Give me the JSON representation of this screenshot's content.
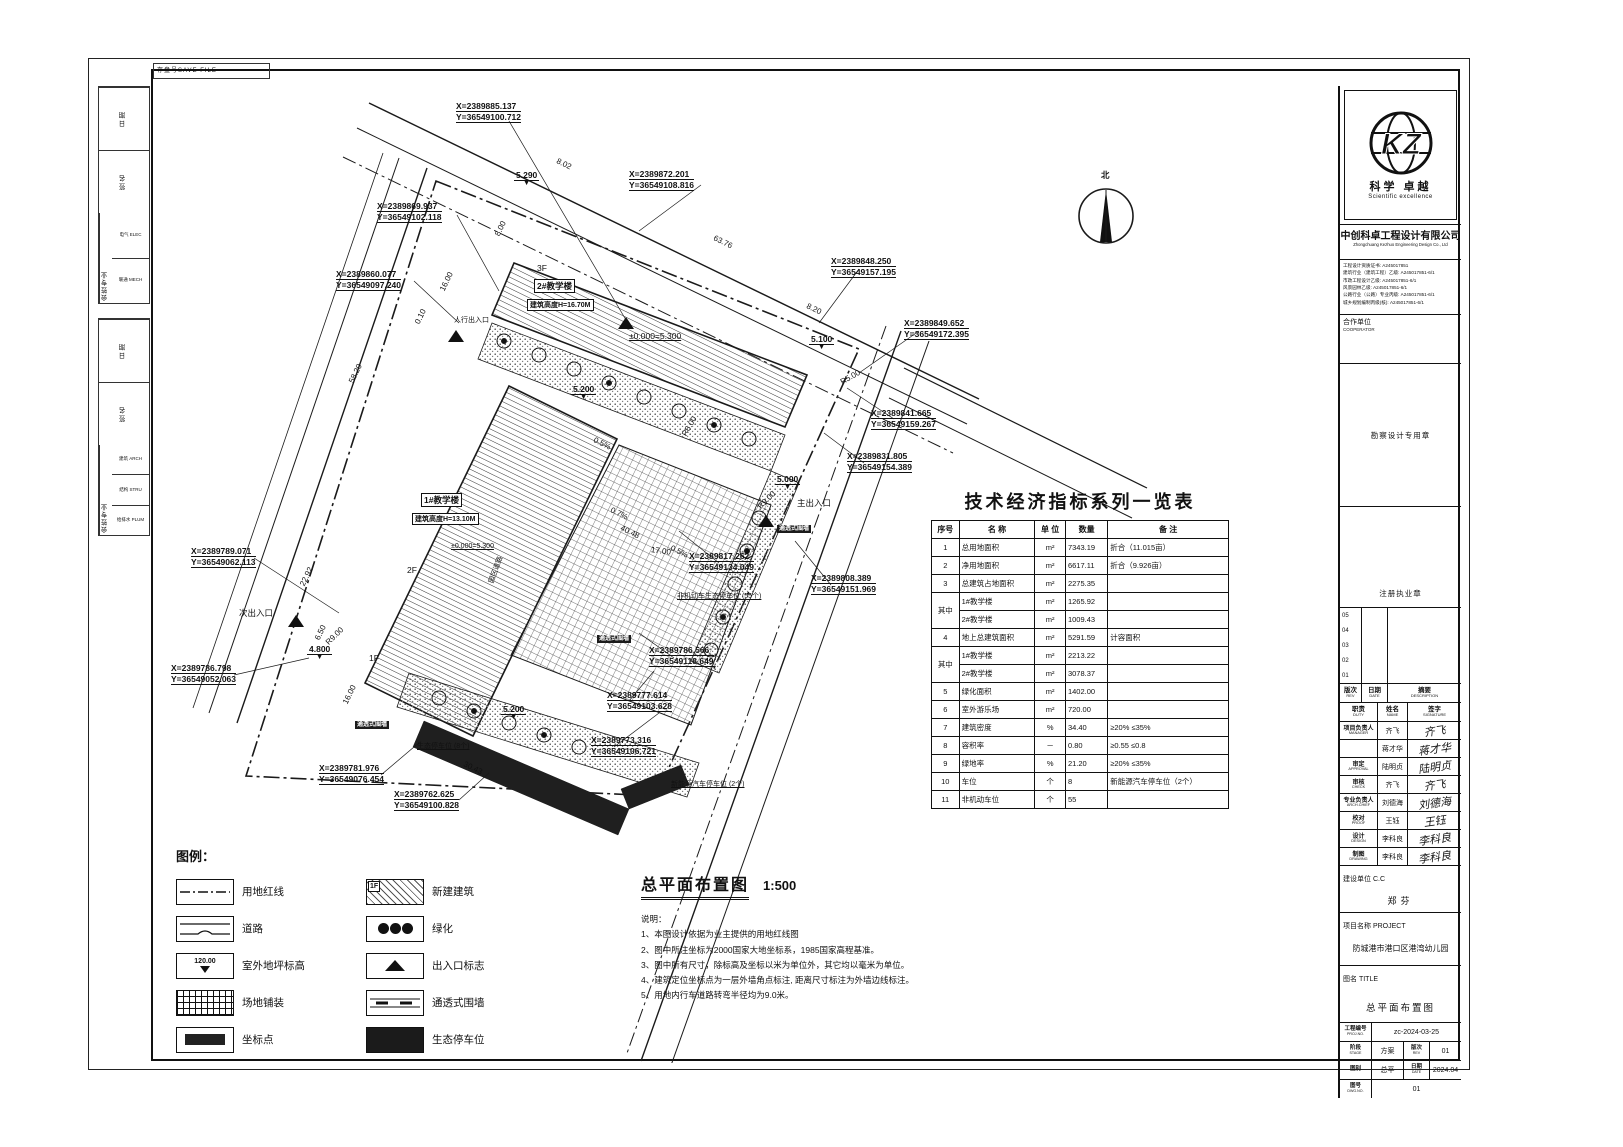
{
  "sheet": {
    "save_file_label": "存盘号SAVE FILE"
  },
  "signoff": {
    "groups": [
      {
        "date_label": "日期",
        "sign_label": "签名",
        "prof_label": "会签专业",
        "disciplines": [
          "电气 ELEC",
          "暖通 MECH"
        ]
      },
      {
        "date_label": "日期",
        "sign_label": "签名",
        "prof_label": "会签专业",
        "disciplines": [
          "建筑 ARCH",
          "结构 STRU",
          "给排水 PLUM"
        ]
      }
    ]
  },
  "plan": {
    "north_label": "北",
    "coords": [
      {
        "x": 297,
        "y": 28,
        "X": "X=2389885.137",
        "Y": "Y=36549100.712"
      },
      {
        "x": 218,
        "y": 128,
        "X": "X=2389869.937",
        "Y": "Y=36549102.118"
      },
      {
        "x": 177,
        "y": 196,
        "X": "X=2389860.077",
        "Y": "Y=36549097.240"
      },
      {
        "x": 470,
        "y": 96,
        "X": "X=2389872.201",
        "Y": "Y=36549108.816"
      },
      {
        "x": 672,
        "y": 183,
        "X": "X=2389848.250",
        "Y": "Y=36549157.195"
      },
      {
        "x": 745,
        "y": 245,
        "X": "X=2389849.652",
        "Y": "Y=36549172.395"
      },
      {
        "x": 712,
        "y": 335,
        "X": "X=2389841.665",
        "Y": "Y=36549159.267"
      },
      {
        "x": 688,
        "y": 378,
        "X": "X=2389831.805",
        "Y": "Y=36549154.389"
      },
      {
        "x": 652,
        "y": 500,
        "X": "X=2389808.389",
        "Y": "Y=36549151.969"
      },
      {
        "x": 530,
        "y": 478,
        "X": "X=2389817.262",
        "Y": "Y=36549134.049"
      },
      {
        "x": 32,
        "y": 473,
        "X": "X=2389789.071",
        "Y": "Y=36549062.113"
      },
      {
        "x": 12,
        "y": 590,
        "X": "X=2389786.798",
        "Y": "Y=36549052.063"
      },
      {
        "x": 490,
        "y": 572,
        "X": "X=2389786.566",
        "Y": "Y=36549118.649"
      },
      {
        "x": 448,
        "y": 617,
        "X": "X=2389777.614",
        "Y": "Y=36549103.628"
      },
      {
        "x": 432,
        "y": 662,
        "X": "X=2389773.316",
        "Y": "Y=36549106.721"
      },
      {
        "x": 160,
        "y": 690,
        "X": "X=2389781.976",
        "Y": "Y=36549076.454"
      },
      {
        "x": 235,
        "y": 716,
        "X": "X=2389762.625",
        "Y": "Y=36549100.828"
      }
    ],
    "labels": [
      {
        "t": "3F",
        "x": 378,
        "y": 190
      },
      {
        "t": "2#教学楼",
        "x": 375,
        "y": 206,
        "cls": "box"
      },
      {
        "t": "建筑高度H=16.70M",
        "x": 368,
        "y": 226,
        "cls": "box small"
      },
      {
        "t": "±0.000=5.300",
        "x": 470,
        "y": 258,
        "cls": "ul"
      },
      {
        "t": "1#教学楼",
        "x": 262,
        "y": 420,
        "cls": "box"
      },
      {
        "t": "建筑高度H=13.10M",
        "x": 253,
        "y": 440,
        "cls": "box small"
      },
      {
        "t": "±0.000=5.300",
        "x": 292,
        "y": 470,
        "cls": "ul small"
      },
      {
        "t": "2F",
        "x": 248,
        "y": 492
      },
      {
        "t": "1F",
        "x": 210,
        "y": 580
      },
      {
        "t": "主出入口",
        "x": 638,
        "y": 424
      },
      {
        "t": "次出入口",
        "x": 80,
        "y": 534
      },
      {
        "t": "人行出入口",
        "x": 295,
        "y": 242,
        "cls": "small"
      },
      {
        "t": "园区道路",
        "x": 332,
        "y": 505,
        "rot": -70,
        "cls": "small"
      },
      {
        "t": "非机动车生态停车位 (55个)",
        "x": 518,
        "y": 518,
        "cls": "small ul"
      },
      {
        "t": "通透式围墙",
        "x": 618,
        "y": 452,
        "cls": "tag"
      },
      {
        "t": "通透式围墙",
        "x": 438,
        "y": 562,
        "cls": "tag"
      },
      {
        "t": "通透式围墙",
        "x": 196,
        "y": 648,
        "cls": "tag"
      },
      {
        "t": "生态停车位 (8个)",
        "x": 258,
        "y": 668,
        "cls": "small ul"
      },
      {
        "t": "新能源汽车停车位 (2个)",
        "x": 512,
        "y": 706,
        "cls": "small ul"
      }
    ],
    "dims": [
      {
        "t": "8.02",
        "x": 398,
        "y": 83,
        "rot": 26
      },
      {
        "t": "63.76",
        "x": 555,
        "y": 160,
        "rot": 26
      },
      {
        "t": "8.20",
        "x": 648,
        "y": 228,
        "rot": 26
      },
      {
        "t": "8.00",
        "x": 338,
        "y": 158,
        "rot": -64
      },
      {
        "t": "16.00",
        "x": 283,
        "y": 213,
        "rot": -64
      },
      {
        "t": "0.10",
        "x": 258,
        "y": 246,
        "rot": -64
      },
      {
        "t": "58.20",
        "x": 192,
        "y": 305,
        "rot": -64
      },
      {
        "t": "22.92",
        "x": 143,
        "y": 508,
        "rot": -64
      },
      {
        "t": "6.50",
        "x": 158,
        "y": 562,
        "rot": -64
      },
      {
        "t": "16.00",
        "x": 186,
        "y": 626,
        "rot": -64
      },
      {
        "t": "30.43",
        "x": 305,
        "y": 686,
        "rot": 26
      },
      {
        "t": "17.00",
        "x": 492,
        "y": 472,
        "rot": 8
      },
      {
        "t": "40.48",
        "x": 462,
        "y": 450,
        "rot": 26,
        "cls": "ul"
      },
      {
        "t": "0.5%",
        "x": 435,
        "y": 362,
        "rot": 26
      },
      {
        "t": "0.7%",
        "x": 452,
        "y": 432,
        "rot": 26
      },
      {
        "t": "0.5%",
        "x": 512,
        "y": 470,
        "rot": 26
      },
      {
        "t": "R9.00",
        "x": 600,
        "y": 430,
        "rot": -45
      },
      {
        "t": "R9.00",
        "x": 168,
        "y": 566,
        "rot": -45
      },
      {
        "t": "R6.00",
        "x": 525,
        "y": 358,
        "rot": -60
      },
      {
        "t": "R5.00",
        "x": 682,
        "y": 305,
        "rot": -30
      }
    ],
    "elevs": [
      {
        "t": "5.290",
        "x": 355,
        "y": 98
      },
      {
        "t": "5.100",
        "x": 650,
        "y": 262
      },
      {
        "t": "5.200",
        "x": 412,
        "y": 312
      },
      {
        "t": "5.000",
        "x": 616,
        "y": 402
      },
      {
        "t": "4.800",
        "x": 148,
        "y": 572
      },
      {
        "t": "5.200",
        "x": 342,
        "y": 632
      }
    ]
  },
  "indicator_table": {
    "title": "技术经济指标系列一览表",
    "headers": [
      "序号",
      "名 称",
      "单 位",
      "数量",
      "备 注"
    ],
    "rows": [
      {
        "no": "1",
        "name": "总用地面积",
        "unit": "m²",
        "qty": "7343.19",
        "note": "折合（11.015亩）"
      },
      {
        "no": "2",
        "name": "净用地面积",
        "unit": "m²",
        "qty": "6617.11",
        "note": "折合（9.926亩）"
      },
      {
        "no": "3",
        "name": "总建筑占地面积",
        "unit": "m²",
        "qty": "2275.35",
        "note": ""
      },
      {
        "no": "其中",
        "no_span": 2,
        "name": "1#教学楼",
        "unit": "m²",
        "qty": "1265.92",
        "note": ""
      },
      {
        "no_span": 0,
        "name": "2#教学楼",
        "unit": "m²",
        "qty": "1009.43",
        "note": ""
      },
      {
        "no": "4",
        "name": "地上总建筑面积",
        "unit": "m²",
        "qty": "5291.59",
        "note": "计容面积"
      },
      {
        "no": "其中",
        "no_span": 2,
        "name": "1#教学楼",
        "unit": "m²",
        "qty": "2213.22",
        "note": ""
      },
      {
        "no_span": 0,
        "name": "2#教学楼",
        "unit": "m²",
        "qty": "3078.37",
        "note": ""
      },
      {
        "no": "5",
        "name": "绿化面积",
        "unit": "m²",
        "qty": "1402.00",
        "note": ""
      },
      {
        "no": "6",
        "name": "室外游乐场",
        "unit": "m²",
        "qty": "720.00",
        "note": ""
      },
      {
        "no": "7",
        "name": "建筑密度",
        "unit": "%",
        "qty": "34.40",
        "note": "≥20% ≤35%"
      },
      {
        "no": "8",
        "name": "容积率",
        "unit": "－",
        "qty": "0.80",
        "note": "≥0.55 ≤0.8"
      },
      {
        "no": "9",
        "name": "绿地率",
        "unit": "%",
        "qty": "21.20",
        "note": "≥20% ≤35%"
      },
      {
        "no": "10",
        "name": "车位",
        "unit": "个",
        "qty": "8",
        "note": "新能源汽车停车位（2个）"
      },
      {
        "no": "11",
        "name": "非机动车位",
        "unit": "个",
        "qty": "55",
        "note": ""
      }
    ]
  },
  "legend": {
    "title": "图例：",
    "elev_sample": "120.00",
    "newbuild_tag": "1F",
    "left": [
      {
        "type": "redline",
        "label": "用地红线"
      },
      {
        "type": "road",
        "label": "道路"
      },
      {
        "type": "elev",
        "label": "室外地坪标高"
      },
      {
        "type": "paving",
        "label": "场地铺装"
      },
      {
        "type": "coord",
        "label": "坐标点"
      }
    ],
    "right": [
      {
        "type": "newbuild",
        "label": "新建建筑"
      },
      {
        "type": "green",
        "label": "绿化"
      },
      {
        "type": "entrance",
        "label": "出入口标志"
      },
      {
        "type": "fence",
        "label": "通透式围墙"
      },
      {
        "type": "parking",
        "label": "生态停车位"
      }
    ]
  },
  "drawing_title": {
    "title": "总平面布置图",
    "scale": "1:500",
    "notes_label": "说明：",
    "notes": [
      "1、本图设计依据为业主提供的用地红线图",
      "2、图中所注坐标为2000国家大地坐标系，1985国家高程基准。",
      "3、图中所有尺寸，除标高及坐标以米为单位外，其它均以毫米为单位。",
      "4、建筑定位坐标点为一层外墙角点标注, 距离尺寸标注为外墙边线标注。",
      "5、用地内行车道路转弯半径均为9.0米。"
    ]
  },
  "titleblock": {
    "logo_text": "KZ",
    "slogan_cn": "科学 卓越",
    "slogan_en": "Scientific excellence",
    "company_cn": "中创科卓工程设计有限公司",
    "company_en": "Zhongchuang Kezhuo Engineering Design Co., Ltd",
    "credentials": [
      "工程设计资质证书: A245017851",
      "建筑行业（建筑工程）乙级: A245017851-6/1",
      "市政工程设计乙级: A245017851-6/1",
      "风景园林乙级: A245017851-6/1",
      "公路行业（公路）专业丙级: A245017851-6/1",
      "城乡规划编制丙级(核): A245017851-6/1"
    ],
    "cooperator_label": "合作单位",
    "cooperator_en": "COOPERATOR",
    "seal1": "勘察设计专用章",
    "seal2": "注册执业章",
    "rev_rows": [
      "05",
      "04",
      "03",
      "02",
      "01"
    ],
    "rev_header": [
      {
        "cn": "版次",
        "en": "REV"
      },
      {
        "cn": "日期",
        "en": "DATE"
      },
      {
        "cn": "摘要",
        "en": "DESCRIPTION"
      }
    ],
    "duty_header": [
      {
        "cn": "职责",
        "en": "DUTY"
      },
      {
        "cn": "姓名",
        "en": "NAME"
      },
      {
        "cn": "签字",
        "en": "SIGNATURE"
      }
    ],
    "personnel": [
      {
        "duty": "项目负责人",
        "en": "MANAGER",
        "span": 2,
        "name": "齐飞"
      },
      {
        "name": "蒋才华"
      },
      {
        "duty": "审定",
        "en": "APPROVAL",
        "name": "陆明贞"
      },
      {
        "duty": "审核",
        "en": "CHECK",
        "name": "齐飞"
      },
      {
        "duty": "专业负责人",
        "en": "ARCH.CHIEF",
        "name": "刘德海"
      },
      {
        "duty": "校对",
        "en": "PROOF",
        "name": "王钰"
      },
      {
        "duty": "设计",
        "en": "DESIGN",
        "name": "李科良"
      },
      {
        "duty": "制图",
        "en": "DRAWING",
        "name": "李科良"
      }
    ],
    "client_label": "建设单位 C.C",
    "client": "郑芬",
    "project_label": "项目名称 PROJECT",
    "project": "防城港市港口区港湾幼儿园",
    "title_label": "图名 TITLE",
    "title": "总平面布置图",
    "proj_no_label": {
      "cn": "工程编号",
      "en": "PROJ.NO."
    },
    "proj_no": "zc-2024-03-25",
    "stage_label": {
      "cn": "阶段",
      "en": "STAGE"
    },
    "stage": "方案",
    "rev_label": {
      "cn": "版次",
      "en": "REV"
    },
    "rev": "01",
    "type_label": {
      "cn": "图别",
      "en": ""
    },
    "type": "总平",
    "date_label": {
      "cn": "日期",
      "en": "DATE"
    },
    "date": "2024.04",
    "dwg_label": {
      "cn": "图号",
      "en": "DWG.NO."
    },
    "dwg": "01"
  }
}
